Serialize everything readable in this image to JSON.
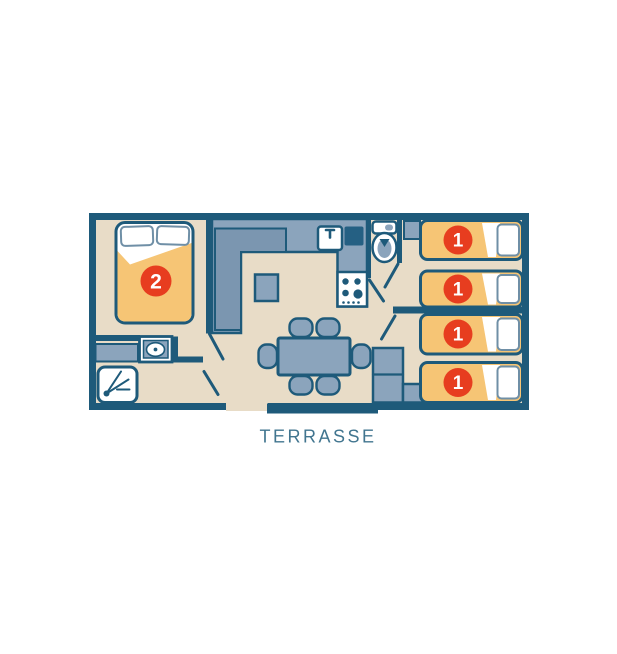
{
  "plan": {
    "terrace_label": "TERRASSE",
    "double_bed_capacity": "2",
    "single_bed_capacities": [
      "1",
      "1",
      "1",
      "1"
    ]
  },
  "colors": {
    "background": "#ffffff",
    "wall": "#1e5a7a",
    "floor": "#e8dcc7",
    "furniture": "#8ba4bc",
    "furniture_dark": "#7b96b0",
    "appliance_dark": "#256083",
    "bed_orange": "#f6c575",
    "badge_red": "#e73d1f",
    "pillow_line": "#6f8fa6",
    "text_teal": "#41758f"
  }
}
